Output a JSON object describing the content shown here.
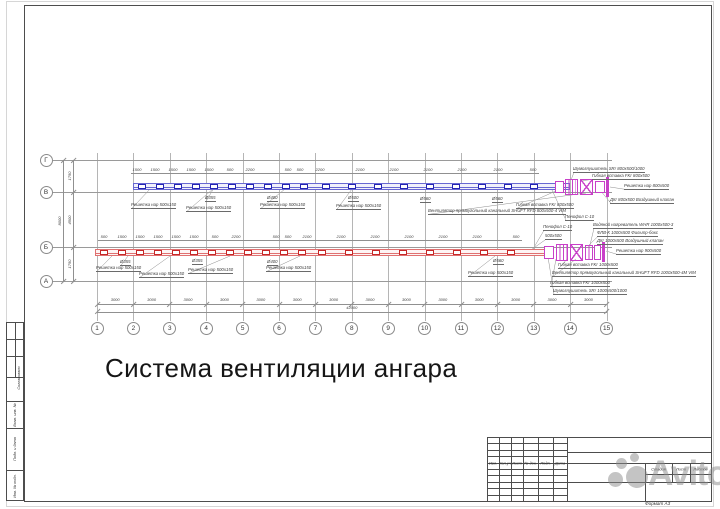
{
  "annotation_title": "Система вентиляции ангара",
  "watermark_text": "Avito",
  "format_label": "Формат А3",
  "colors": {
    "supply_duct": "#6868d2",
    "supply_fill": "#f1f1fb",
    "supply_grille": "#2424b4",
    "exhaust_duct": "#e07070",
    "exhaust_fill": "#fdf4f4",
    "exhaust_grille": "#c62828",
    "equipment": "#c840c8",
    "grid_line": "#b5b5b5",
    "axis_line": "#9a9a9a",
    "dim_line": "#909090",
    "frame_line": "#4d4d4d"
  },
  "grid_axes": {
    "row_axes": [
      {
        "label": "Г",
        "y": 160
      },
      {
        "label": "В",
        "y": 192
      },
      {
        "label": "Б",
        "y": 247
      },
      {
        "label": "А",
        "y": 281
      }
    ],
    "column_axes": {
      "labels": [
        "1",
        "2",
        "3",
        "4",
        "5",
        "6",
        "7",
        "8",
        "9",
        "10",
        "11",
        "12",
        "13",
        "14",
        "15"
      ],
      "start_x": 97,
      "step": 36.4
    }
  },
  "dimensions": {
    "left_vertical": {
      "segments": [
        "1750",
        "4500",
        "1750"
      ],
      "total": "8000"
    },
    "bottom_horizontal": {
      "per_bay": "3000",
      "bay_count": 14,
      "total": "42000"
    },
    "supply_dim_row": {
      "y": 168,
      "items": [
        {
          "x": 137,
          "t": "1500"
        },
        {
          "x": 155,
          "t": "1500"
        },
        {
          "x": 173,
          "t": "1500"
        },
        {
          "x": 191,
          "t": "1500"
        },
        {
          "x": 209,
          "t": "1500"
        },
        {
          "x": 230,
          "t": "500"
        },
        {
          "x": 250,
          "t": "2200"
        },
        {
          "x": 288,
          "t": "500"
        },
        {
          "x": 300,
          "t": "500"
        },
        {
          "x": 320,
          "t": "2200"
        },
        {
          "x": 360,
          "t": "2100"
        },
        {
          "x": 394,
          "t": "2100"
        },
        {
          "x": 428,
          "t": "2100"
        },
        {
          "x": 462,
          "t": "2100"
        },
        {
          "x": 498,
          "t": "2100"
        },
        {
          "x": 533,
          "t": "500"
        }
      ]
    },
    "exhaust_dim_row": {
      "y": 235,
      "items": [
        {
          "x": 104,
          "t": "500"
        },
        {
          "x": 122,
          "t": "1500"
        },
        {
          "x": 140,
          "t": "1500"
        },
        {
          "x": 158,
          "t": "1500"
        },
        {
          "x": 176,
          "t": "1500"
        },
        {
          "x": 194,
          "t": "1500"
        },
        {
          "x": 215,
          "t": "500"
        },
        {
          "x": 236,
          "t": "2200"
        },
        {
          "x": 276,
          "t": "500"
        },
        {
          "x": 288,
          "t": "500"
        },
        {
          "x": 307,
          "t": "2100"
        },
        {
          "x": 341,
          "t": "2100"
        },
        {
          "x": 375,
          "t": "2100"
        },
        {
          "x": 409,
          "t": "2100"
        },
        {
          "x": 443,
          "t": "2100"
        },
        {
          "x": 477,
          "t": "2100"
        },
        {
          "x": 516,
          "t": "500"
        }
      ]
    }
  },
  "ducts": {
    "supply": {
      "x1": 133,
      "x2": 570,
      "y": 183,
      "h": 7,
      "gw": 8,
      "gh": 5,
      "grille_xs": [
        138,
        156,
        174,
        192,
        210,
        228,
        246,
        264,
        282,
        300,
        322,
        348,
        374,
        400,
        426,
        452,
        478,
        504,
        530
      ]
    },
    "exhaust": {
      "x1": 95,
      "x2": 546,
      "y": 249,
      "h": 7,
      "gw": 8,
      "gh": 5,
      "grille_xs": [
        100,
        118,
        136,
        154,
        172,
        190,
        208,
        226,
        244,
        262,
        280,
        298,
        318,
        345,
        372,
        399,
        426,
        453,
        480,
        507
      ]
    }
  },
  "equipment": {
    "supply": [
      {
        "x": 555,
        "y": 181,
        "w": 9,
        "h": 12,
        "k": "box"
      },
      {
        "x": 565,
        "y": 179,
        "w": 13,
        "h": 16,
        "k": "lines"
      },
      {
        "x": 580,
        "y": 179,
        "w": 13,
        "h": 16,
        "k": "xbox"
      },
      {
        "x": 595,
        "y": 181,
        "w": 10,
        "h": 12,
        "k": "box"
      },
      {
        "x": 606,
        "y": 177,
        "w": 3,
        "h": 20,
        "k": "bar"
      }
    ],
    "exhaust": [
      {
        "x": 544,
        "y": 246,
        "w": 10,
        "h": 13,
        "k": "box"
      },
      {
        "x": 556,
        "y": 244,
        "w": 12,
        "h": 17,
        "k": "lines"
      },
      {
        "x": 570,
        "y": 244,
        "w": 13,
        "h": 17,
        "k": "xbox"
      },
      {
        "x": 585,
        "y": 245,
        "w": 8,
        "h": 15,
        "k": "lines"
      },
      {
        "x": 594,
        "y": 245,
        "w": 7,
        "h": 15,
        "k": "box"
      },
      {
        "x": 602,
        "y": 242,
        "w": 3,
        "h": 20,
        "k": "bar"
      }
    ]
  },
  "callouts": [
    {
      "t": "Решетка нар 500х150",
      "x": 131,
      "y": 203,
      "tx": 150,
      "ty": 189
    },
    {
      "t": "Решетка нар 500х150",
      "x": 186,
      "y": 206,
      "tx": 213,
      "ty": 189
    },
    {
      "t": "Ø355",
      "x": 205,
      "y": 196,
      "tx": 214,
      "ty": 188
    },
    {
      "t": "Решетка нар 500х150",
      "x": 260,
      "y": 203,
      "tx": 285,
      "ty": 189
    },
    {
      "t": "Ø400",
      "x": 267,
      "y": 196
    },
    {
      "t": "Решетка нар 500х150",
      "x": 336,
      "y": 204,
      "tx": 352,
      "ty": 189
    },
    {
      "t": "Ø500",
      "x": 348,
      "y": 196
    },
    {
      "t": "Ø560",
      "x": 420,
      "y": 197
    },
    {
      "t": "Ø560",
      "x": 492,
      "y": 197
    },
    {
      "t": "Шумоглушитель SRr 800х500/1000",
      "x": 573,
      "y": 167,
      "tx": 571,
      "ty": 180
    },
    {
      "t": "Гибкая вставка FKr 800х500",
      "x": 592,
      "y": 174,
      "tx": 580,
      "ty": 181
    },
    {
      "t": "Решетка нар 800х500",
      "x": 624,
      "y": 184,
      "tx": 610,
      "ty": 187
    },
    {
      "t": "ДКr 800х500 Воздушный клапан",
      "x": 610,
      "y": 198,
      "tx": 600,
      "ty": 190
    },
    {
      "t": "Гибкая вставка FKr 800х500",
      "x": 516,
      "y": 203,
      "tx": 558,
      "ty": 190
    },
    {
      "t": "Вентилятор прямоугольный канальный SHUFT RFD 800х500-4 VIM",
      "x": 428,
      "y": 209,
      "tx": 586,
      "ty": 193
    },
    {
      "t": "Пенофол С-10",
      "x": 565,
      "y": 215,
      "tx": 552,
      "ty": 190
    },
    {
      "t": "Пенофол С-10",
      "x": 543,
      "y": 225,
      "tx": 533,
      "ty": 249
    },
    {
      "t": "500х500",
      "x": 545,
      "y": 234,
      "tx": 528,
      "ty": 252
    },
    {
      "t": "Ø355",
      "x": 120,
      "y": 260,
      "tx": 128,
      "ty": 256
    },
    {
      "t": "Решетка нар 500х150",
      "x": 96,
      "y": 266,
      "tx": 112,
      "ty": 256
    },
    {
      "t": "Решетка нар 500х150",
      "x": 139,
      "y": 272,
      "tx": 170,
      "ty": 256
    },
    {
      "t": "Ø355",
      "x": 192,
      "y": 259
    },
    {
      "t": "Решетка нар 500х150",
      "x": 188,
      "y": 268,
      "tx": 230,
      "ty": 256
    },
    {
      "t": "Ø400",
      "x": 267,
      "y": 260
    },
    {
      "t": "Решетка нар 500х150",
      "x": 266,
      "y": 266,
      "tx": 300,
      "ty": 256
    },
    {
      "t": "Ø560",
      "x": 493,
      "y": 259
    },
    {
      "t": "Решетка нар 500х150",
      "x": 468,
      "y": 271,
      "tx": 495,
      "ty": 256
    },
    {
      "t": "Водяной нагреватель WHR 1000х500-3",
      "x": 593,
      "y": 223,
      "tx": 590,
      "ty": 245
    },
    {
      "t": "ФЛВ-К 1000х500 Фильтр-бокс",
      "x": 597,
      "y": 231,
      "tx": 588,
      "ty": 246
    },
    {
      "t": "ДКr 1000х500 Воздушный клапан",
      "x": 597,
      "y": 239,
      "tx": 596,
      "ty": 247
    },
    {
      "t": "Решетка нар 900х500",
      "x": 616,
      "y": 249,
      "tx": 606,
      "ty": 251
    },
    {
      "t": "Гибкая вставка FKr 1000х500",
      "x": 558,
      "y": 263,
      "tx": 568,
      "ty": 258
    },
    {
      "t": "Вентилятор прямоугольный канальный SHUFT RFD 1000х500-4М VIM",
      "x": 552,
      "y": 271,
      "tx": 576,
      "ty": 259
    },
    {
      "t": "Гибкая вставка FKr 1000х500",
      "x": 550,
      "y": 281,
      "tx": 556,
      "ty": 259
    },
    {
      "t": "Шумоглушитель SRr 1000х500/1000",
      "x": 553,
      "y": 289,
      "tx": 548,
      "ty": 257
    }
  ],
  "title_block": {
    "rev_headers": [
      "Изм.",
      "Кол.уч",
      "Лист",
      "№ док.",
      "Подп.",
      "Дата"
    ],
    "stage_headers": [
      "Стадия",
      "Лист",
      "Листов"
    ]
  },
  "side_strip_labels": [
    "Согласовано",
    "Взам. инв. №",
    "Подп. и дата",
    "Инв. № подл."
  ]
}
